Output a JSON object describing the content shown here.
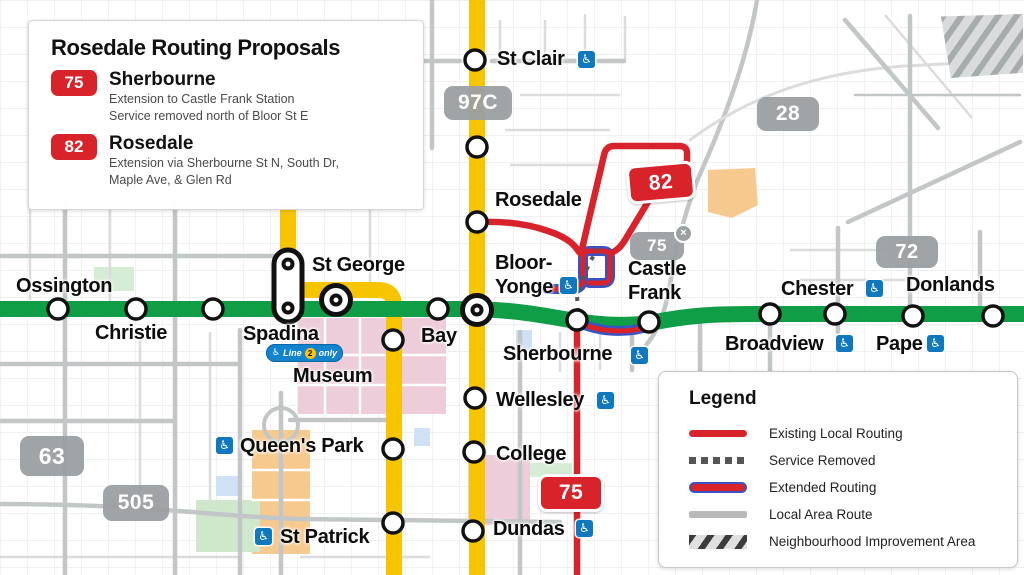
{
  "title_box": {
    "title": "Rosedale Routing Proposals",
    "routes": [
      {
        "number": "75",
        "name": "Sherbourne",
        "description": [
          "Extension to Castle Frank Station",
          "Service removed north of Bloor St E"
        ]
      },
      {
        "number": "82",
        "name": "Rosedale",
        "description": [
          "Extension via Sherbourne St N, South Dr,",
          "Maple Ave, & Glen Rd"
        ]
      }
    ]
  },
  "legend": {
    "title": "Legend",
    "items": [
      {
        "label": "Existing Local Routing"
      },
      {
        "label": "Service Removed"
      },
      {
        "label": "Extended Routing"
      },
      {
        "label": "Local Area Route"
      },
      {
        "label": "Neighbourhood Improvement Area"
      }
    ]
  },
  "map": {
    "stations": {
      "ossington": "Ossington",
      "christie": "Christie",
      "spadina": "Spadina",
      "st_george": "St George",
      "museum": "Museum",
      "bay": "Bay",
      "bloor1": "Bloor-",
      "bloor2": "Yonge",
      "sherbourne": "Sherbourne",
      "castle1": "Castle",
      "castle2": "Frank",
      "broadview": "Broadview",
      "chester": "Chester",
      "pape": "Pape",
      "donlands": "Donlands",
      "st_clair": "St Clair",
      "rosedale": "Rosedale",
      "wellesley": "Wellesley",
      "college": "College",
      "dundas": "Dundas",
      "queens_park": "Queen's Park",
      "st_patrick": "St Patrick"
    },
    "route_badges": {
      "b97c": "97C",
      "b28": "28",
      "b72": "72",
      "b63": "63",
      "b505": "505",
      "b75": "75",
      "b82": "82",
      "b75_removed": "75",
      "removed_mark": "×"
    },
    "spadina_badge": {
      "icon": "♿",
      "word1": "Line",
      "number": "2",
      "word2": "only"
    },
    "accessibility_icon": "♿"
  },
  "colors": {
    "subway_green": "#0f9d45",
    "subway_yellow": "#f6c500",
    "route_red": "#d8232a",
    "extended_outline_blue": "#3a53c4",
    "local_route_gray": "#9ba0a3",
    "accessibility_blue": "#0f78be"
  }
}
